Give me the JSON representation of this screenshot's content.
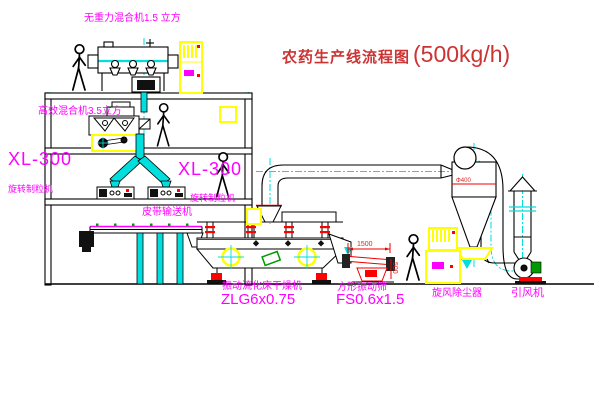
{
  "title": {
    "name": "农药生产线流程图",
    "capacity": "(500kg/h)"
  },
  "equipment_labels": {
    "gravity_free_mixer": "无重力混合机1.5 立方",
    "high_efficiency_mixer": "高效混合机3.5立方",
    "granulator_left_model": "XL-300",
    "granulator_left_name": "旋转制粒机",
    "granulator_right_model": "XL-300",
    "granulator_right_name": "旋转制粒机",
    "belt_conveyor": "皮带输送机",
    "fluid_bed_dryer_name": "振动流化床干燥机",
    "fluid_bed_dryer_model": "ZLG6x0.75",
    "vibrating_screen_name": "方形振动筛",
    "vibrating_screen_model": "FS0.6x1.5",
    "cyclone": "旋风除尘器",
    "induced_draft_fan": "引风机"
  },
  "dimensions": {
    "screen_length": "1500",
    "screen_height": "500",
    "cyclone_diameter": "Φ400"
  },
  "colors": {
    "line": "#000000",
    "centerline": "#00dede",
    "label_magenta": "#ff00ff",
    "title_red": "#cc3333",
    "cabinet_yellow": "#ffff00",
    "accent_red": "#ff0000",
    "accent_green": "#009900"
  }
}
